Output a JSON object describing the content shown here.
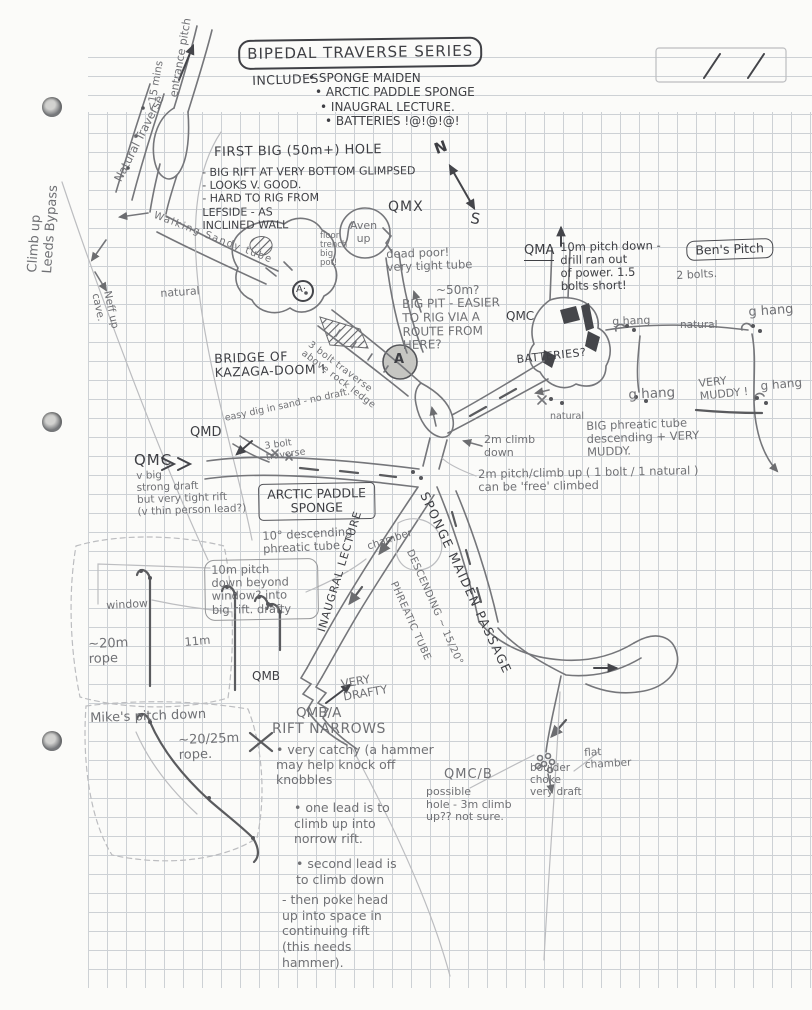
{
  "page": {
    "date_marks": "/  /"
  },
  "colors": {
    "ink": "#3e3f44",
    "pencil": "#707175",
    "grid": "#cdd1d5",
    "paper": "#fbfbf9"
  },
  "header": {
    "title": "BIPEDAL TRAVERSE SERIES",
    "includes_label": "INCLUDES",
    "includes": [
      "SPONGE MAIDEN",
      "ARCTIC PADDLE SPONGE",
      "INAUGRAL LECTURE.",
      "BATTERIES !@!@!@!"
    ]
  },
  "compass": {
    "north": "N",
    "south": "S"
  },
  "annotations": {
    "entrance_pitch": "entrance pitch",
    "entrance_time": "<15 mins",
    "natural_traverse": "Natural Traverse",
    "leeds_bypass": "Climb up\nLeeds Bypass",
    "walking_tube": "Walking Sandy tube",
    "neff_cave": "Neff up\ncave.",
    "natural_top": "natural",
    "first_hole_title": "FIRST BIG (50m+) HOLE",
    "first_hole_notes": "- BIG RIFT AT VERY BOTTOM GLIMPSED\n- LOOKS V. GOOD.\n- HARD TO RIG FROM\n   LEFSIDE - AS\n   INCLINED WALL",
    "aven_up": "Aven\nup",
    "qmx": "QMX",
    "floor_trench": "floor\ntrench\nbig\npot!",
    "dead_poor": "dead poor!\nvery tight tube",
    "big_pit_depth": "~50m?",
    "big_pit_note": "BIG PIT - EASIER\nTO RIG VIA A\nROUTE FROM\nHERE?",
    "a_star": "A·",
    "a_main": "A",
    "bolt_traverse_rock": "3 bolt traverse\nabove rock ledge",
    "bridge": "BRIDGE OF\nKAZAGA-DOOM !",
    "qma": "QMA",
    "qma_note": "10m pitch down -\n drill ran out\n of power. 1.5\n bolts short!",
    "bens_pitch": "Ben's Pitch",
    "bens_bolts": "2 bolts.",
    "qmc_right": "QMC",
    "ghang_a": "g hang",
    "ghang_b": "g hang",
    "ghang_c": "g hang",
    "ghang_d": "g hang",
    "natural_right_a": "natural",
    "natural_right_b": "natural",
    "very_muddy": "VERY\nMUDDY !",
    "batteries": "BATTERIES?",
    "big_phreatic": "BIG phreatic tube\ndescending + VERY\n        MUDDY.",
    "climb_2m": "2m climb\n   down",
    "pitch_2m": "2m pitch/climb up  ( 1 bolt / 1 natural )\n can be 'free' climbed",
    "qmd": "QMD",
    "qmd_note": "easy dig in sand - no draft.",
    "qmc_left": "QMC",
    "qmc_left_note": "v big\nstrong draft\nbut very tight rift\n(v thin person lead?)",
    "bolt_traverse_3": "3 bolt\ntraverse",
    "arctic_paddle": "ARCTIC PADDLE\nSPONGE",
    "desc_tube": "10° descending\nphreatic tube",
    "chamber": "chamber",
    "inaugural_passage": "INAUGRAL LECTURE",
    "pitch_10m": "10m pitch\ndown beyond\nwindow? into\nbig rift. drafty",
    "window": "window",
    "rope_20m": "~20m\n rope",
    "eleven_m": "11m",
    "sponge_maiden_passage": "SPONGE MAIDEN PASSAGE",
    "descending_15": "DESCENDING ~ 15/20°",
    "phreatic_tube": "PHREATIC TUBE",
    "mikes_pitch": "Mike's pitch down",
    "mikes_rope": "~20/25m\n  rope.",
    "qmb": "QMB",
    "very_drafty": "VERY\nDRAFTY",
    "qmb_a": "QMB/A",
    "rift_narrows": "RIFT NARROWS",
    "rift_note_1": "• very catchy (a hammer\nmay help knock off\n knobbles",
    "rift_note_2": "• one lead is to\n climb up into\n norrow rift.",
    "rift_note_3": "• second lead is\nto climb down",
    "rift_note_4": "- then poke head\n up into space in\ncontinuing rift\n(this needs\n   hammer).",
    "qmc_b": "QMC/B",
    "qmc_b_note": "   possible\nhole - 3m climb\nup?? not sure.",
    "boulder_choke": "boulder\nchoke\nvery draft",
    "flat_chamber": "flat\nchamber"
  }
}
